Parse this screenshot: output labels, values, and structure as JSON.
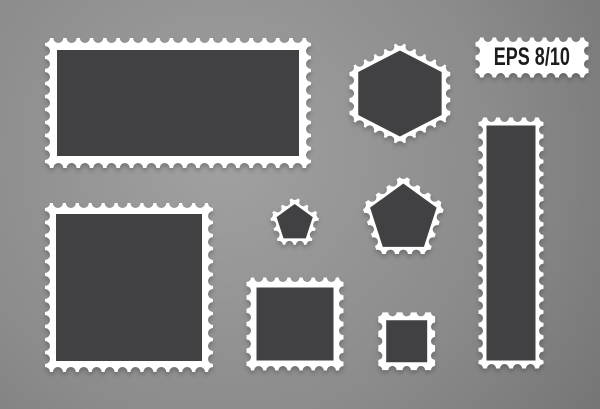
{
  "badge": {
    "label": "EPS 8/10"
  },
  "colors": {
    "bg_center": "#a1a1a1",
    "bg_mid": "#8b8b8b",
    "bg_edge": "#707070",
    "stamp_paper": "#ffffff",
    "stamp_inner": "#414144",
    "badge_text": "#1c1c1c"
  },
  "stamps": [
    {
      "name": "stamp-rect-wide",
      "shape": "rect",
      "x": 45,
      "y": 38,
      "w": 266,
      "h": 130,
      "inset": 12,
      "perf_spacing": 13.3,
      "perf_radius": 5
    },
    {
      "name": "stamp-hexagon",
      "shape": "polygon",
      "sides": 6,
      "cx": 400,
      "cy": 93,
      "r": 52,
      "stretch_x": 1.12,
      "inset": 9,
      "perf_spacing": 12.5,
      "perf_radius": 4.5
    },
    {
      "name": "eps-badge-frame",
      "shape": "rect",
      "x": 475,
      "y": 37,
      "w": 113,
      "h": 40,
      "inset": 0,
      "perf_spacing": 13,
      "perf_radius": 4.5
    },
    {
      "name": "stamp-square-large",
      "shape": "rect",
      "x": 45,
      "y": 203,
      "w": 168,
      "h": 169,
      "inset": 11,
      "perf_spacing": 13.2,
      "perf_radius": 5
    },
    {
      "name": "stamp-pentagon-small",
      "shape": "polygon",
      "sides": 5,
      "cx": 295,
      "cy": 223,
      "r": 27,
      "inset": 8,
      "perf_spacing": 11,
      "perf_radius": 4
    },
    {
      "name": "stamp-pentagon-large",
      "shape": "polygon",
      "sides": 5,
      "cx": 403,
      "cy": 218,
      "r": 44,
      "inset": 9,
      "perf_spacing": 12,
      "perf_radius": 4.5
    },
    {
      "name": "stamp-square-medium",
      "shape": "rect",
      "x": 246,
      "y": 277,
      "w": 97,
      "h": 93,
      "inset": 10,
      "perf_spacing": 12.5,
      "perf_radius": 4.5
    },
    {
      "name": "stamp-square-small",
      "shape": "rect",
      "x": 378,
      "y": 312,
      "w": 57,
      "h": 58,
      "inset": 8,
      "perf_spacing": 13,
      "perf_radius": 4.2
    },
    {
      "name": "stamp-rect-tall",
      "shape": "rect",
      "x": 478,
      "y": 117,
      "w": 65,
      "h": 251,
      "inset": 8,
      "perf_spacing": 12.5,
      "perf_radius": 4.5
    }
  ]
}
